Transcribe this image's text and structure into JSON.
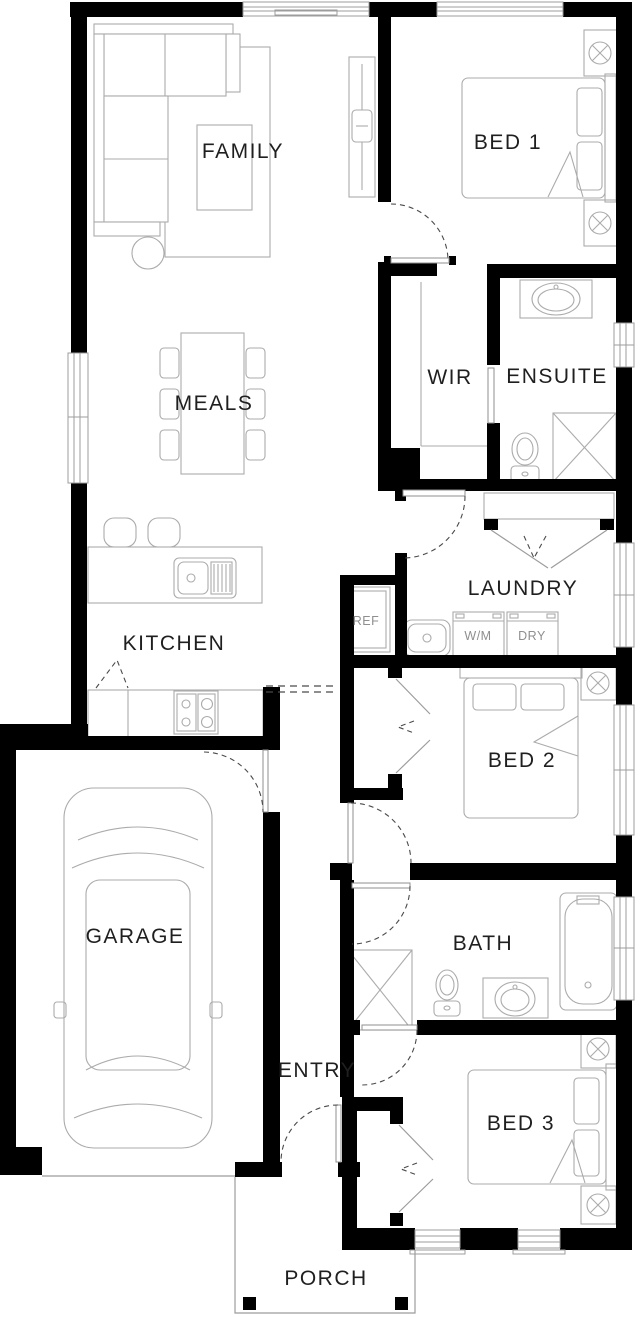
{
  "plan": {
    "title": "single-storey house floor plan",
    "rooms": {
      "family": "FAMILY",
      "bed1": "BED 1",
      "wir": "WIR",
      "ensuite": "ENSUITE",
      "meals": "MEALS",
      "laundry": "LAUNDRY",
      "kitchen": "KITCHEN",
      "bed2": "BED 2",
      "garage": "GARAGE",
      "bath": "BATH",
      "entry": "ENTRY",
      "bed3": "BED 3",
      "porch": "PORCH"
    },
    "appliances": {
      "fridge": "REF",
      "washer": "W/M",
      "dryer": "DRY"
    },
    "colors": {
      "wall": "#000000",
      "furniture_line": "#ababab",
      "room_label": "#1f1f1f",
      "appliance_label": "#8f8f8f",
      "background": "#ffffff"
    }
  }
}
